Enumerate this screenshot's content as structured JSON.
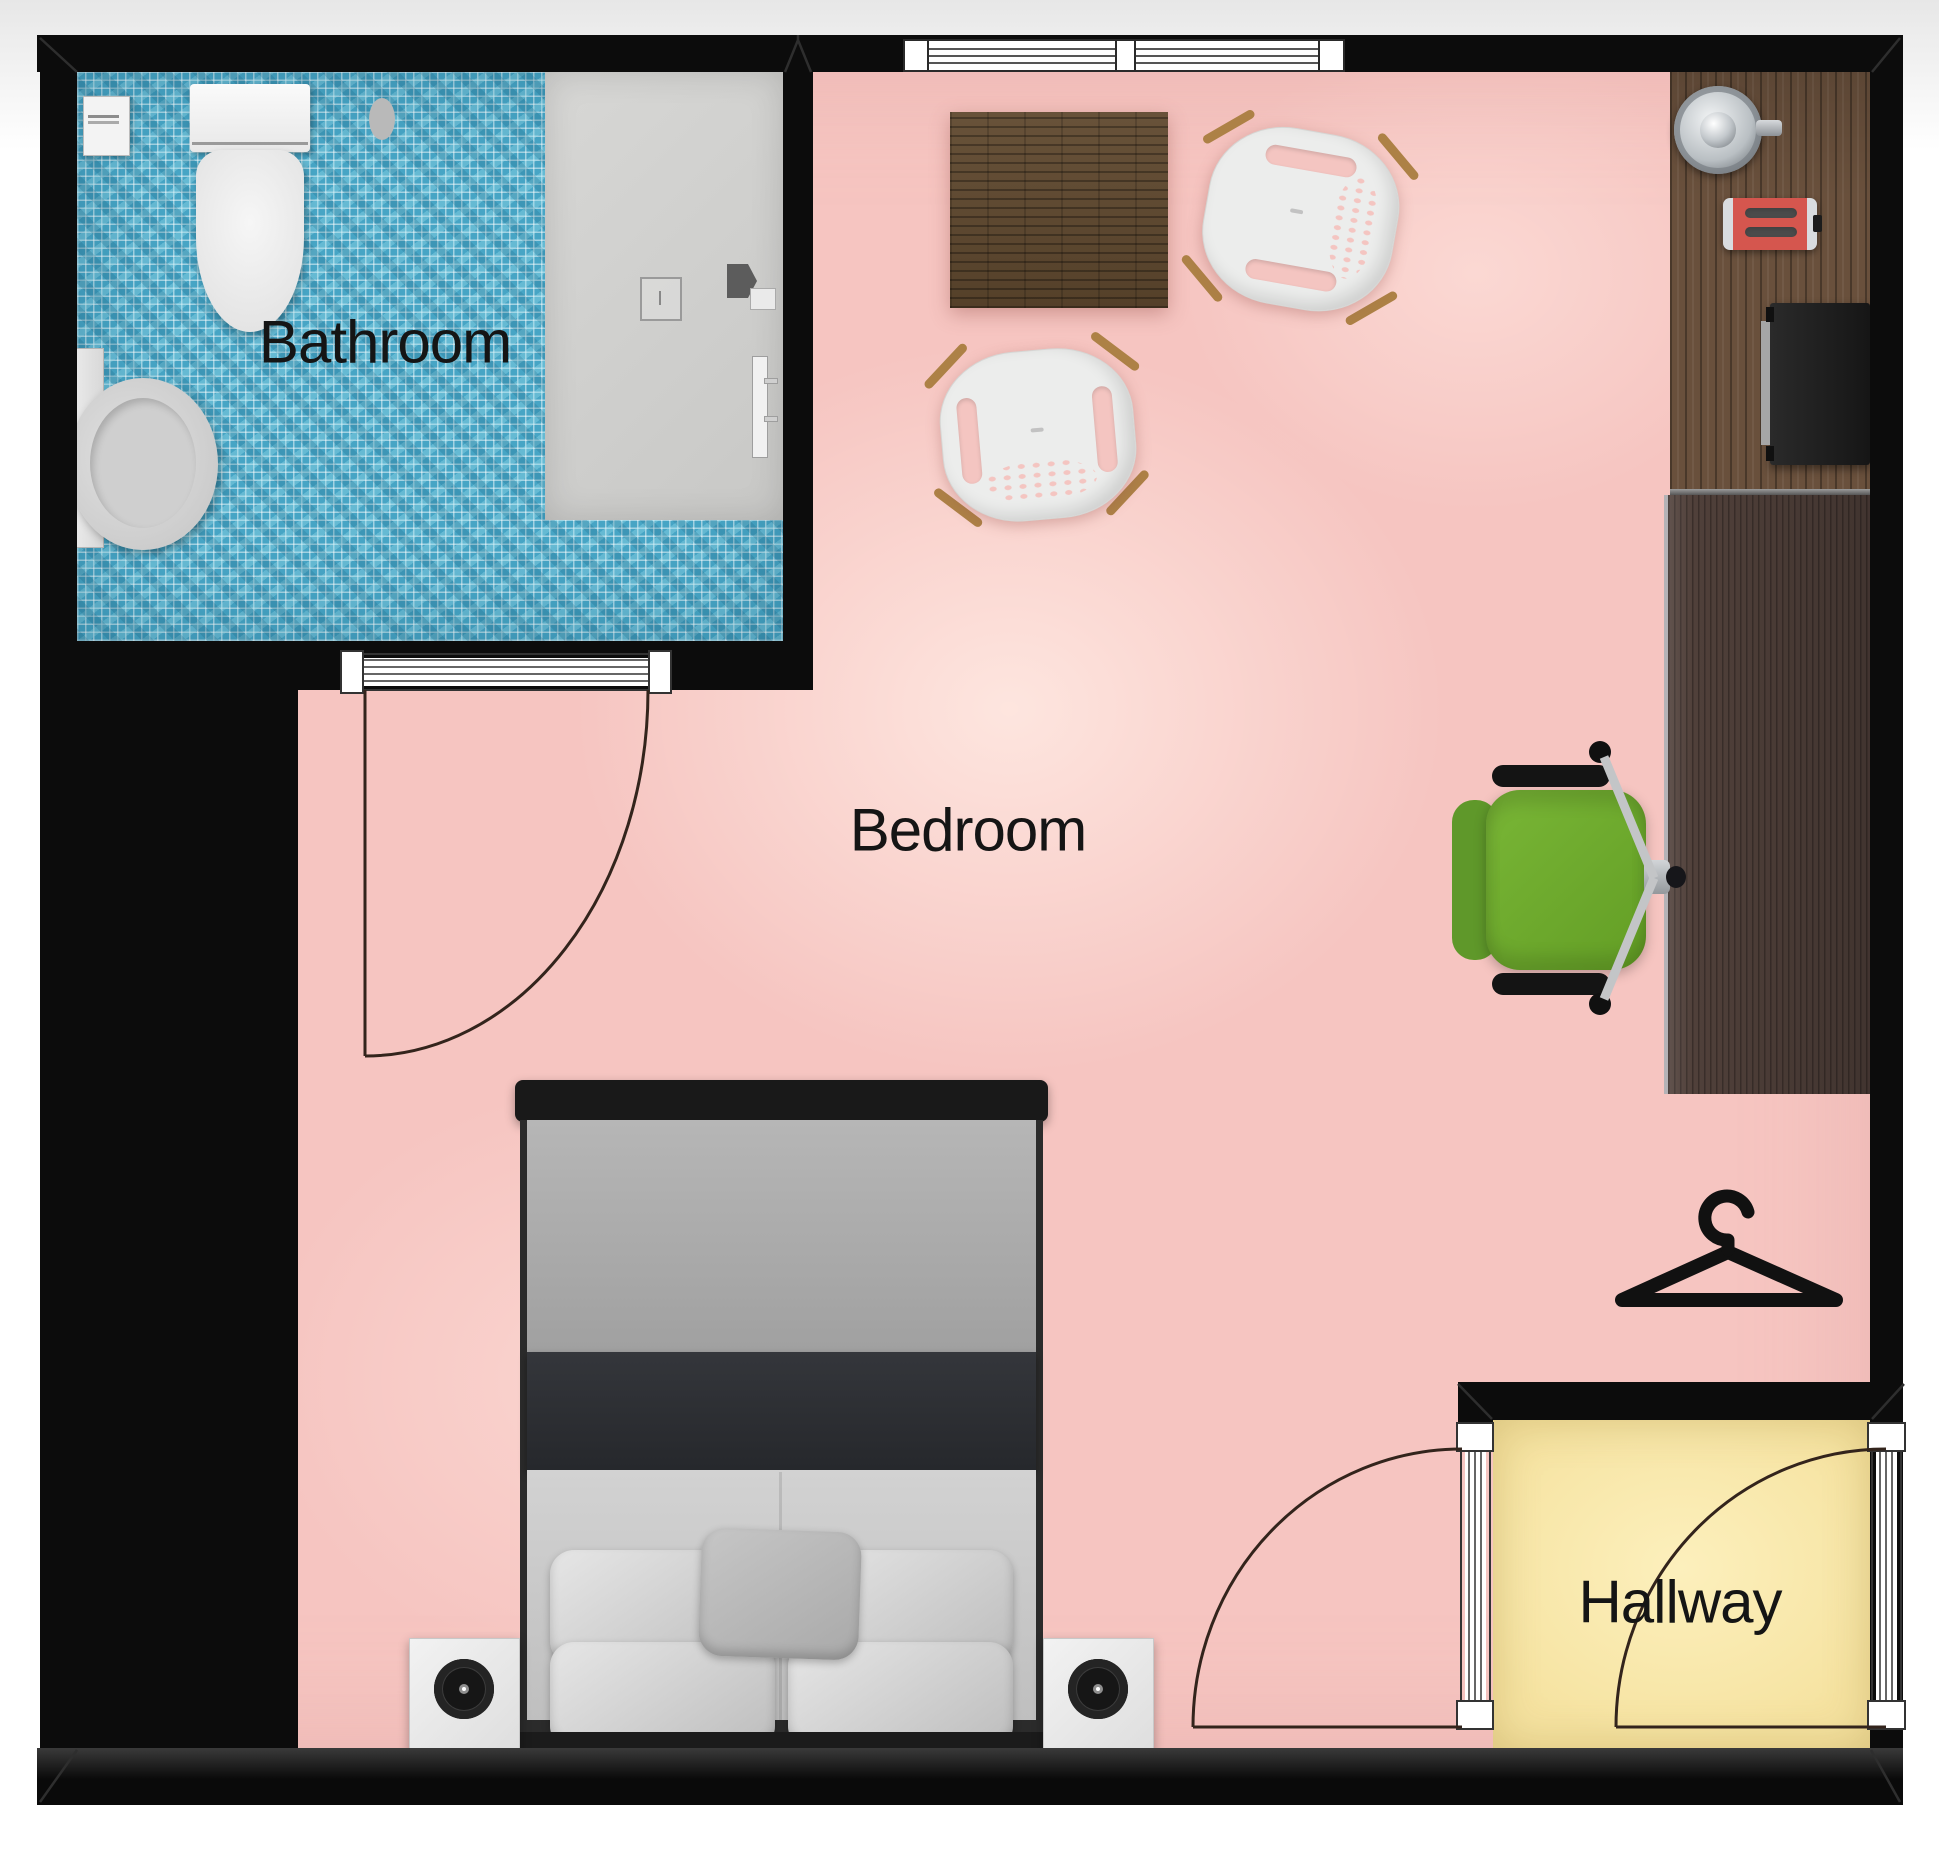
{
  "plan": {
    "type": "apartment-floorplan-top-view",
    "rooms": {
      "bathroom": {
        "label": "Bathroom",
        "floor_color": "#47a5c5",
        "floor_style": "blue-mosaic-tile",
        "furniture": [
          "toilet",
          "toilet-paper-holder",
          "sink-vanity",
          "shower-cabin",
          "shower-head",
          "shower-mixer-knob",
          "shower-rail"
        ]
      },
      "bedroom": {
        "label": "Bedroom",
        "floor_color": "#f6c5c1",
        "furniture": [
          "double-bed",
          "nightstand-with-speaker-left",
          "nightstand-with-speaker-right",
          "square-dining-table",
          "white-shell-chair-upper",
          "white-shell-chair-lower",
          "kitchen-counter",
          "kettle",
          "toaster",
          "tv-screen",
          "desk",
          "green-office-chair",
          "clothes-hanger"
        ]
      },
      "hallway": {
        "label": "Hallway",
        "floor_color": "#f6e3a1",
        "furniture": []
      }
    },
    "openings": {
      "top_window_panes": 2,
      "bathroom_door": "swing-into-bedroom",
      "hallway_door_left": "swing-into-bedroom",
      "hallway_door_right": "swing-into-hallway"
    },
    "colors": {
      "wall": "#0c0c0c",
      "bedroom_floor": "#f6c5c1",
      "bathroom_tile": "#47a5c5",
      "hallway_floor": "#f6e3a1",
      "counter_wood": "#69503c",
      "desk_wood": "#50403a",
      "table_wood": "#60492f",
      "office_chair_green": "#6fae2a",
      "toaster_red": "#d5564e",
      "bed_blanket_dark": "#2c2e32",
      "window_frame": "#ffffff"
    }
  }
}
